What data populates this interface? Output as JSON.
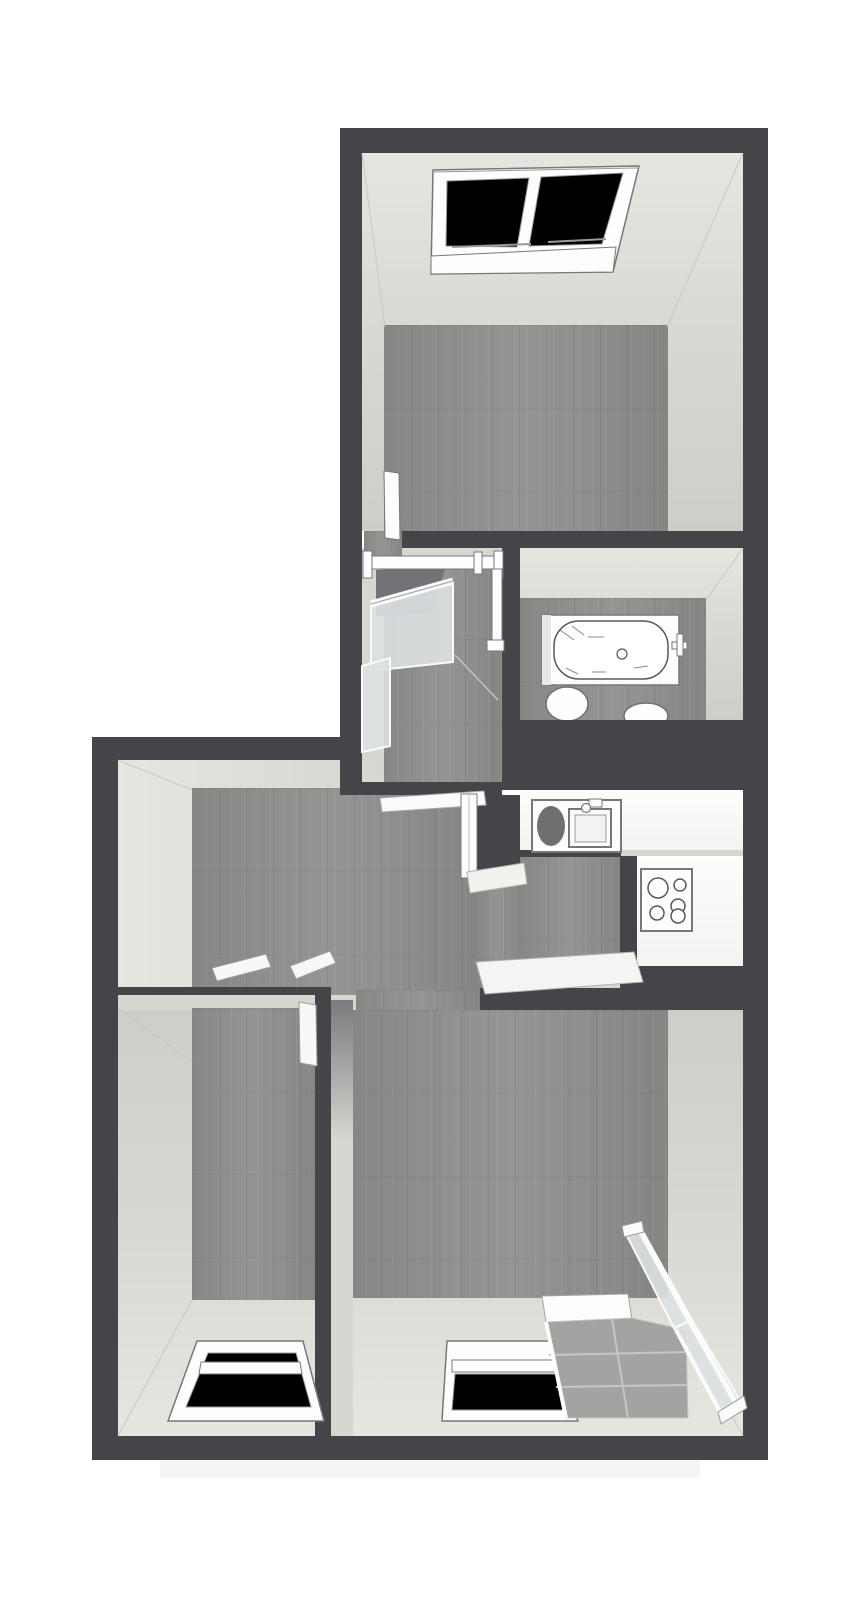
{
  "meta": {
    "type": "3d-floor-plan",
    "view": "top-down perspective",
    "visible_text": "none"
  },
  "palette": {
    "background": "#ffffff",
    "wall": "#454549",
    "wall_top_beige": "#d8d6d0",
    "wall_beige_dim": "#cfcdc7",
    "room_wall_light": "#e7e5df",
    "wall_shadow": "#7a7a7d",
    "wood_floor": "#8f8f8d",
    "fixture_white": "#fdfdfd",
    "fixture_stroke": "#77777a",
    "stroke_light": "#9a9a98",
    "sketch": "#59595c",
    "basin": "#6f6f72",
    "stairwell": "#737377",
    "glass": "#dde1e2",
    "glass_frame": "#fbfbfb",
    "tile": "#a3a3a1",
    "tile_line": "#c6c6c4",
    "cap_white": "#f4f4f2",
    "corner_line": "#c9c7c1",
    "shadow": "#f5f4f3"
  },
  "rooms": [
    {
      "id": "attic-room-top",
      "floor": "wood",
      "features": [
        "skylight-window",
        "open-door"
      ]
    },
    {
      "id": "stair-landing",
      "floor": "wood",
      "features": [
        "stairwell-opening",
        "railing",
        "glass-balustrade",
        "door-to-hallway"
      ]
    },
    {
      "id": "bathroom",
      "floor": "wood",
      "features": [
        "bathtub",
        "toilet",
        "bidet"
      ]
    },
    {
      "id": "hallway",
      "floor": "wood",
      "features": [
        "door-thresholds",
        "open-passage"
      ]
    },
    {
      "id": "kitchen",
      "floor": "wood",
      "features": [
        "sink-unit",
        "cooktop",
        "l-shaped-counter"
      ]
    },
    {
      "id": "bedroom-left",
      "floor": "wood",
      "features": [
        "skylight-window",
        "open-door"
      ]
    },
    {
      "id": "living-room",
      "floor": "wood",
      "features": [
        "window",
        "balcony-access"
      ]
    },
    {
      "id": "balcony",
      "floor": "tile",
      "features": [
        "glass-balustrade",
        "window"
      ]
    }
  ],
  "fixtures": {
    "skylight_windows": 2,
    "windows": 2,
    "bathtub": 1,
    "toilets": 2,
    "kitchen_sink": 1,
    "cooktop_burners": 4,
    "glass_balustrade_panels": 4,
    "doors_visible": 4
  }
}
